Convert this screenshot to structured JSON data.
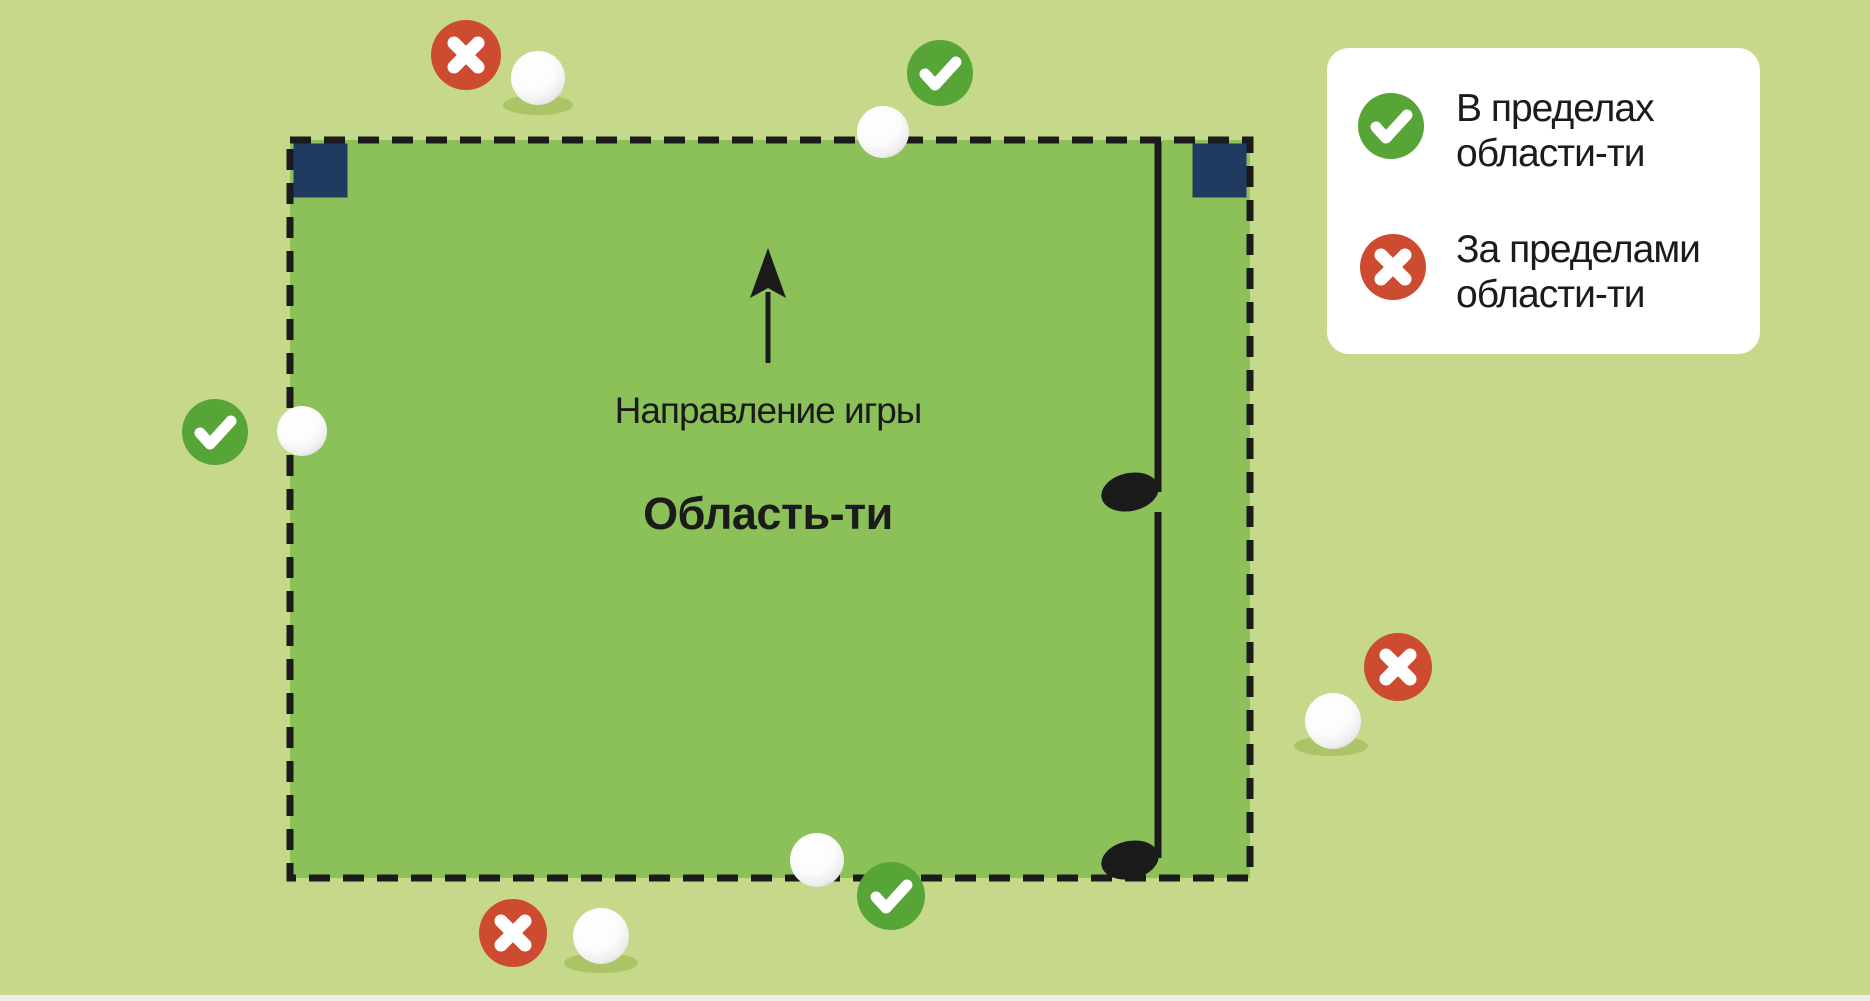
{
  "diagram": {
    "area_label": "Область-ти",
    "direction_label": "Направление игры"
  },
  "legend": {
    "items": [
      {
        "icon": "check-icon",
        "status": "within",
        "line1": "В пределах",
        "line2": "области-ти"
      },
      {
        "icon": "cross-icon",
        "status": "outside",
        "line1": "За пределами",
        "line2": "области-ти"
      }
    ]
  },
  "markers": [
    {
      "ball": "top-left-outside",
      "status": "outside"
    },
    {
      "ball": "top-center-on-line",
      "status": "within"
    },
    {
      "ball": "left-edge-on-line",
      "status": "within"
    },
    {
      "ball": "bottom-center-on-line",
      "status": "within"
    },
    {
      "ball": "bottom-left-outside",
      "status": "outside"
    },
    {
      "ball": "right-outside",
      "status": "outside"
    }
  ],
  "colors": {
    "background": "#c6d889",
    "tee_area_fill": "#8bc158",
    "border_black": "#1b1b1b",
    "tee_marker_navy": "#213a60",
    "status_green": "#57a537",
    "status_red": "#cd4b30",
    "ball_shadow": "#abc465",
    "legend_background": "#ffffff",
    "text": "#1b1b1b"
  }
}
